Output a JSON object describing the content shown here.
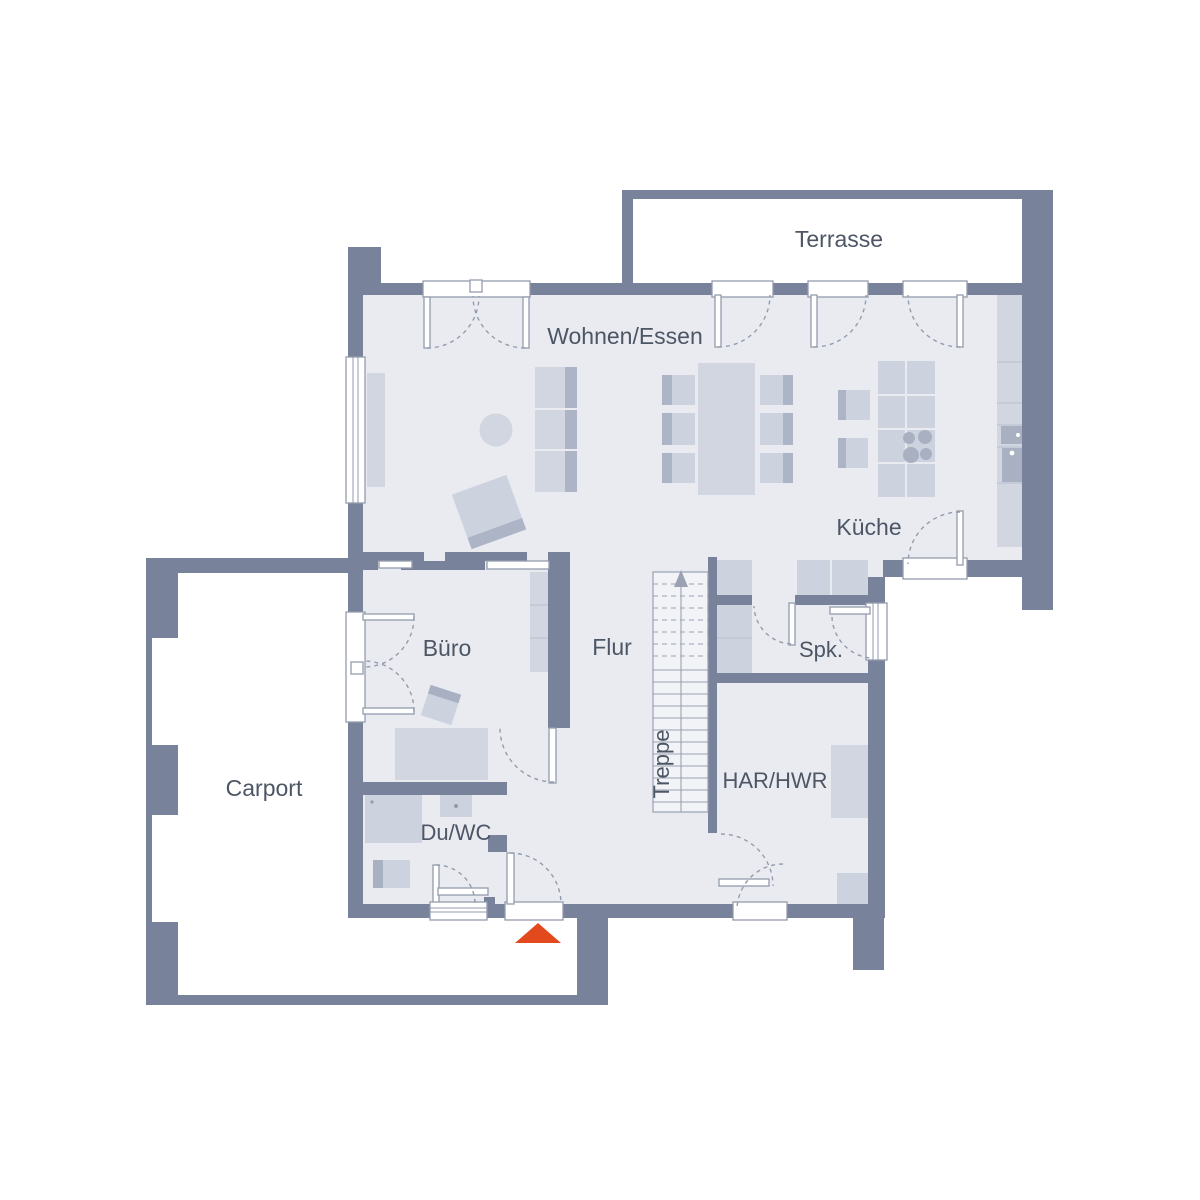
{
  "floorplan": {
    "rooms": {
      "terrasse": "Terrasse",
      "wohnen_essen": "Wohnen/Essen",
      "kueche": "Küche",
      "buero": "Büro",
      "flur": "Flur",
      "treppe": "Treppe",
      "spk": "Spk.",
      "har_hwr": "HAR/HWR",
      "du_wc": "Du/WC",
      "carport": "Carport"
    }
  },
  "colors": {
    "wall": "#78839B",
    "floor": "#E9EBF1",
    "stairfloor": "#F2F3F7",
    "furniture": "#D2D6E1",
    "furniture2": "#CDD2DF",
    "furniture_dark": "#ACB4C6",
    "appliance": "#A8B0C2",
    "line": "#939CAD",
    "divider": "#BCC2D1",
    "stairline": "#99A1B2",
    "text": "#4D5665",
    "accent": "#E2491D"
  }
}
